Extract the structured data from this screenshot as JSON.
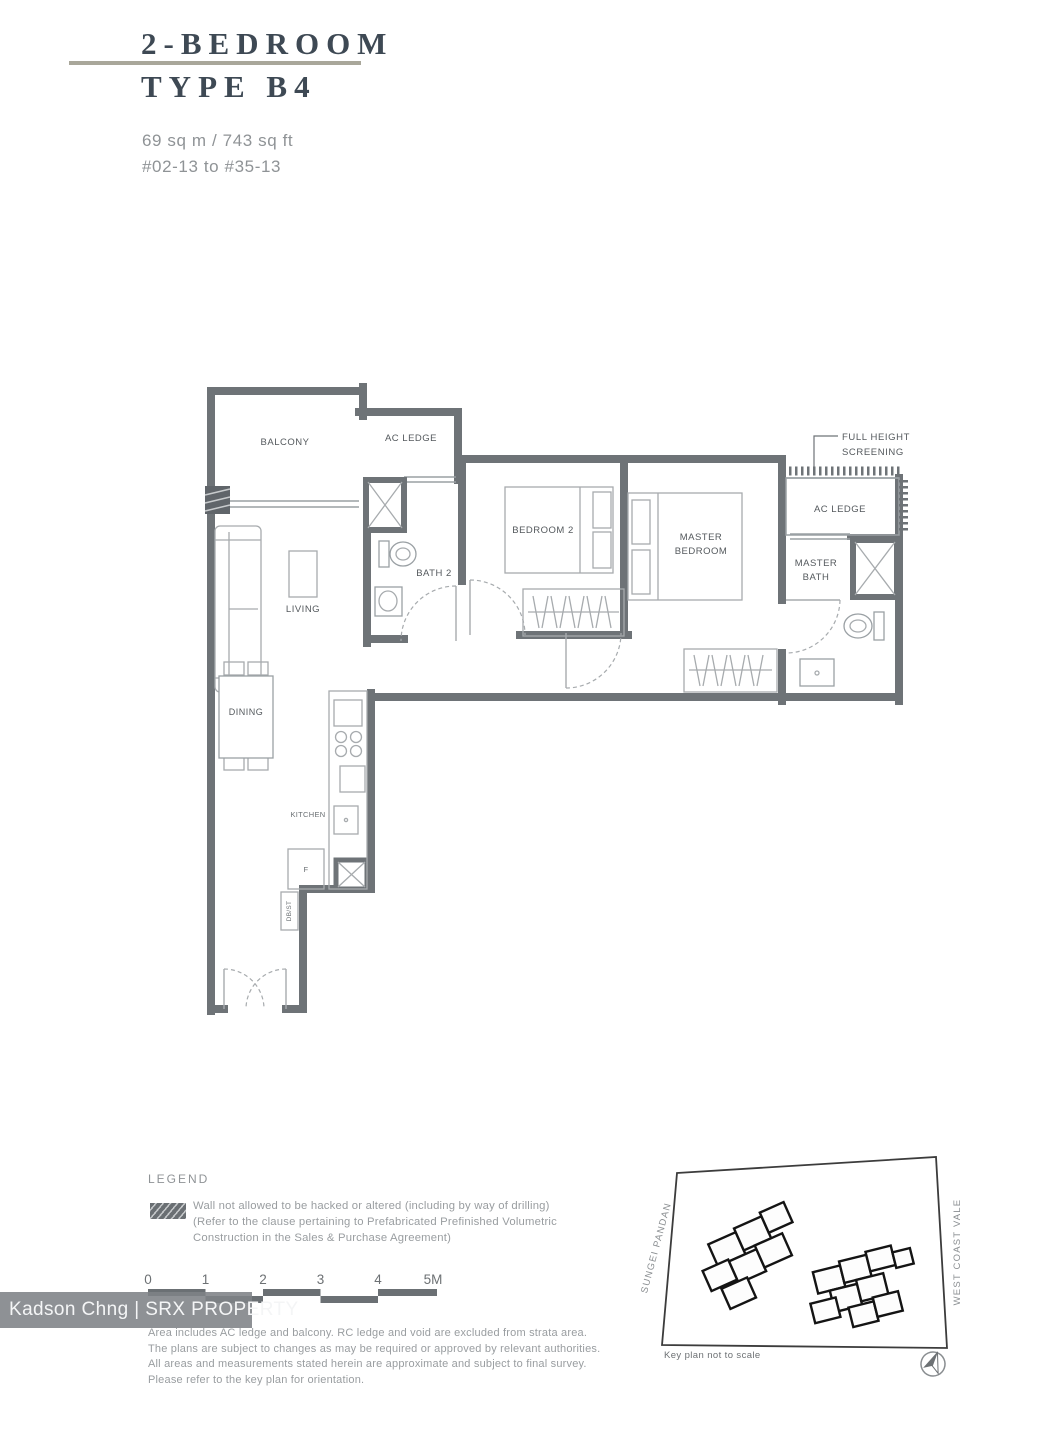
{
  "header": {
    "title": "2-BEDROOM",
    "type": "TYPE B4",
    "area": "69 sq m / 743 sq ft",
    "units": "#02-13 to #35-13"
  },
  "rooms": {
    "balcony": "BALCONY",
    "ac_ledge_1": "AC LEDGE",
    "living": "LIVING",
    "bath2": "BATH 2",
    "bedroom2": "BEDROOM 2",
    "master_line1": "MASTER",
    "master_line2": "BEDROOM",
    "master_bath_line1": "MASTER",
    "master_bath_line2": "BATH",
    "ac_ledge_2": "AC LEDGE",
    "dining": "DINING",
    "kitchen": "KITCHEN",
    "fridge": "F",
    "dbst": "DB/ST"
  },
  "callout": {
    "line1": "FULL HEIGHT",
    "line2": "SCREENING"
  },
  "legend": {
    "heading": "LEGEND",
    "lines": [
      "Wall not allowed to be hacked or altered (including by way of drilling)",
      "(Refer to the clause pertaining to Prefabricated Prefinished Volumetric",
      "Construction in the Sales & Purchase Agreement)"
    ]
  },
  "scalebar": {
    "labels": [
      "0",
      "1",
      "2",
      "3",
      "4",
      "5M"
    ]
  },
  "watermark": {
    "text": "Kadson Chng | SRX PROPERTY"
  },
  "disclaimer": {
    "lines": [
      "Area includes AC ledge and balcony. RC ledge and void are excluded from strata area.",
      "The plans are subject to changes as may be required or approved by relevant authorities.",
      "All areas and measurements stated herein are approximate and subject to final survey.",
      "Please refer to the key plan for orientation."
    ]
  },
  "keyplan": {
    "road_left": "SUNGEI PANDAN",
    "road_right": "WEST COAST VALE",
    "note": "Key plan not to scale"
  },
  "colors": {
    "wall": "#6e7377",
    "title_rule": "#a9a79a",
    "unit_highlight": "#96907e",
    "watermark_bg": "#7e8286",
    "text_muted": "#999da0"
  }
}
